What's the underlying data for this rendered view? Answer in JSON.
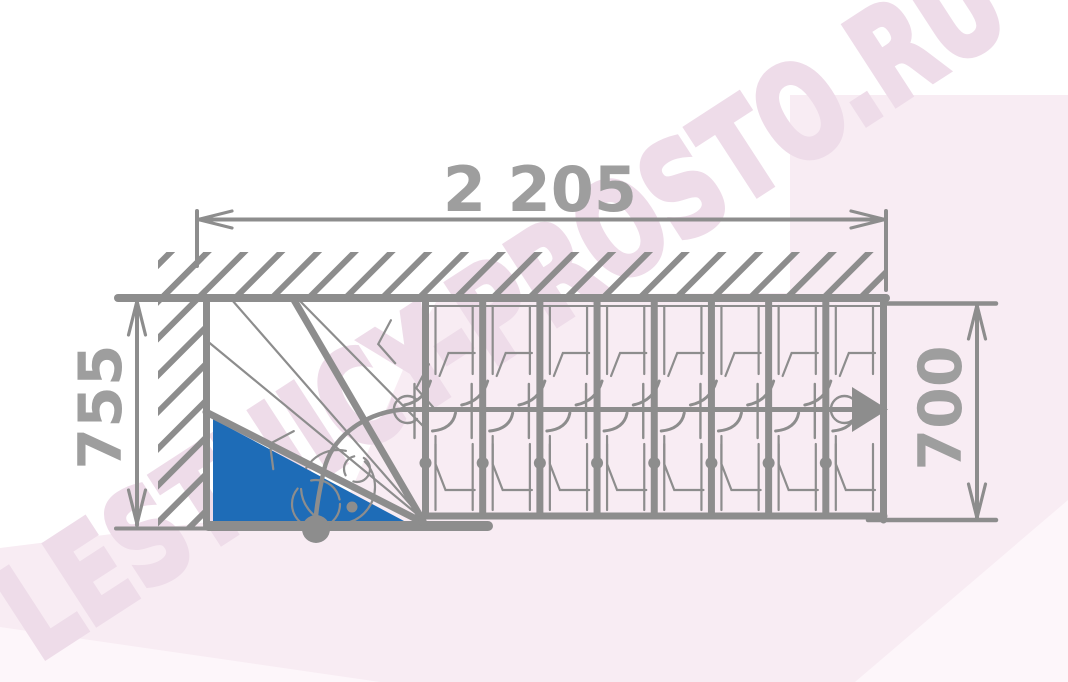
{
  "drawing": {
    "type": "staircase-floor-plan-top-view-with-winder",
    "dimensions": {
      "top": "2 205",
      "left": "755",
      "right": "700"
    },
    "watermark": "LESTNICY-PROSTO.RU",
    "stairs": {
      "straight_treads": 8,
      "winder_treads": 3,
      "travel_direction": "right"
    },
    "colors": {
      "line": "#8d8d8d",
      "dim_text": "#9e9e9e",
      "winder_fill": "#1e6cb7",
      "tint": "#f8ecf3",
      "tint_light": "#fdf6fa",
      "watermark_text": "#eedce9",
      "background": "#ffffff"
    }
  }
}
